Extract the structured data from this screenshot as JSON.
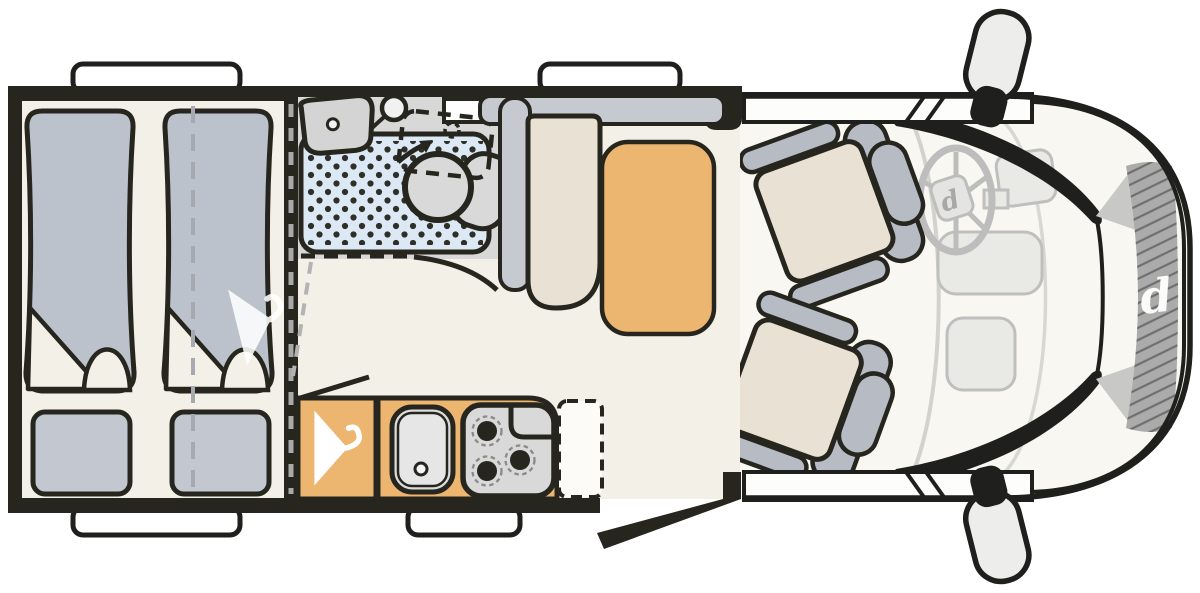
{
  "logo": {
    "letter": "d"
  },
  "colors": {
    "outline": "#26261F",
    "floor": "#F3F0E7",
    "accent_orange": "#ECB670",
    "bed_gray": "#BCC2CB",
    "pillow_gray": "#C3C8D0",
    "seat_back_gray": "#B6BBC4",
    "cushion_beige": "#E9E1D4",
    "shower_blue": "#DCE9F5",
    "bathroom_gray": "#D8D8D8",
    "cabinet_gray": "#C6C9CF",
    "fixture_gray": "#D9D9D9",
    "dash_gray": "#E9E9E6",
    "grille_gray": "#ABABAB",
    "window_white": "#FDFDFB"
  },
  "icons": {
    "hanger": "hanger-icon",
    "shower_head": "shower-head-icon",
    "rotation_arrow": "rotation-arrow-icon",
    "steering_wheel": "steering-wheel-icon",
    "brand_logo": "brand-d-logo",
    "mirror": "side-mirror-icon"
  }
}
